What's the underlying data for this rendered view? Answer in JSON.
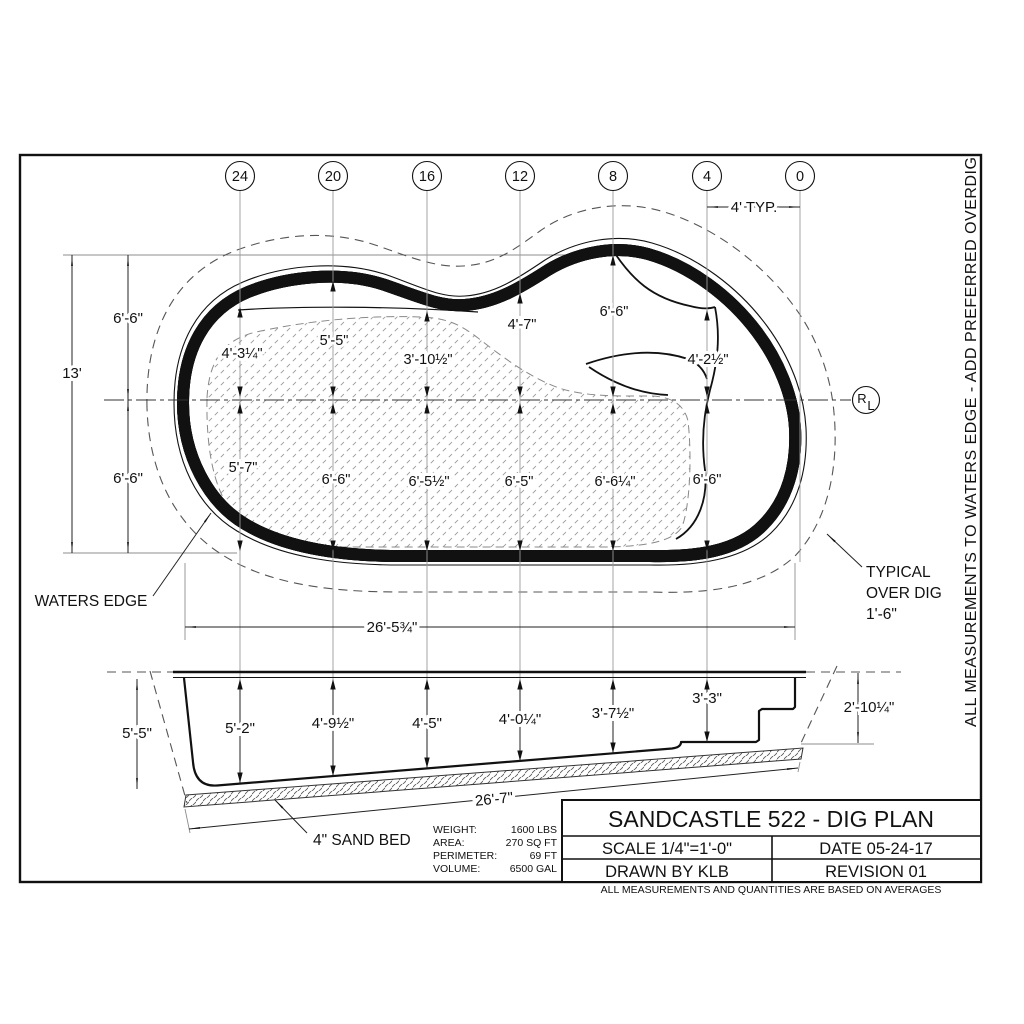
{
  "drawing": {
    "title": "SANDCASTLE 522 - DIG PLAN",
    "scale": "SCALE 1/4\"=1'-0\"",
    "date": "DATE 05-24-17",
    "drawn_by": "DRAWN BY KLB",
    "revision": "REVISION 01",
    "disclaimer": "ALL MEASUREMENTS AND QUANTITIES ARE BASED ON AVERAGES",
    "side_note": "ALL MEASUREMENTS TO WATERS EDGE - ADD PREFERRED OVERDIG"
  },
  "stats": [
    {
      "label": "WEIGHT:",
      "value": "1600 LBS"
    },
    {
      "label": "AREA:",
      "value": "270 SQ FT"
    },
    {
      "label": "PERIMETER:",
      "value": "69 FT"
    },
    {
      "label": "VOLUME:",
      "value": "6500 GAL"
    }
  ],
  "grid": {
    "labels": [
      "24",
      "20",
      "16",
      "12",
      "8",
      "4",
      "0"
    ],
    "typ_label": "4' TYP."
  },
  "plan": {
    "height_total": "13'",
    "height_upper": "6'-6\"",
    "height_lower": "6'-6\"",
    "width": "26'-5¾\"",
    "depths_upper": [
      "4'-3¼\"",
      "5'-5\"",
      "3'-10½\"",
      "4'-7\"",
      "6'-6\"",
      "4'-2½\""
    ],
    "depths_lower": [
      "5'-7\"",
      "6'-6\"",
      "6'-5½\"",
      "6'-5\"",
      "6'-6¼\"",
      "6'-6\""
    ],
    "waters_edge_label": "WATERS EDGE",
    "overdig_note": [
      "TYPICAL",
      "OVER DIG",
      "1'-6\""
    ],
    "centerline_symbol": {
      "top": "R",
      "bottom": "L"
    }
  },
  "section": {
    "depths": [
      "5'-2\"",
      "4'-9½\"",
      "4'-5\"",
      "4'-0¼\"",
      "3'-7½\"",
      "3'-3\""
    ],
    "left_depth": "5'-5\"",
    "right_depth": "2'-10¼\"",
    "length": "26'-7\"",
    "sand_bed_label": "4\" SAND BED"
  }
}
